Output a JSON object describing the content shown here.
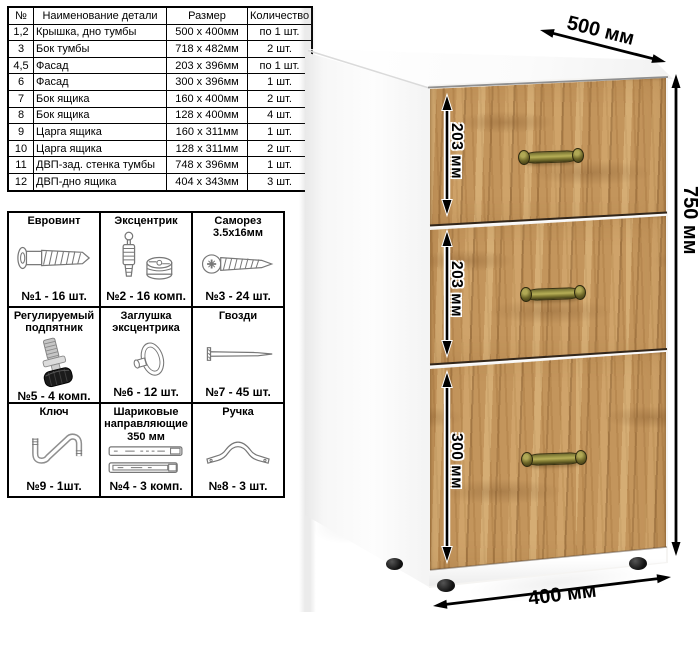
{
  "parts_table": {
    "headers": [
      "№",
      "Наименование детали",
      "Размер",
      "Количество"
    ],
    "rows": [
      [
        "1,2",
        "Крышка, дно тумбы",
        "500 x 400мм",
        "по 1 шт."
      ],
      [
        "3",
        "Бок тумбы",
        "718 x 482мм",
        "2 шт."
      ],
      [
        "4,5",
        "Фасад",
        "203 x 396мм",
        "по 1 шт."
      ],
      [
        "6",
        "Фасад",
        "300 x 396мм",
        "1 шт."
      ],
      [
        "7",
        "Бок ящика",
        "160 x 400мм",
        "2 шт."
      ],
      [
        "8",
        "Бок ящика",
        "128 x 400мм",
        "4 шт."
      ],
      [
        "9",
        "Царга ящика",
        "160 x 311мм",
        "1 шт."
      ],
      [
        "10",
        "Царга ящика",
        "128 x 311мм",
        "2 шт."
      ],
      [
        "11",
        "ДВП-зад. стенка тумбы",
        "748 x 396мм",
        "1 шт."
      ],
      [
        "12",
        "ДВП-дно ящика",
        "404 x 343мм",
        "3 шт."
      ]
    ]
  },
  "hardware": [
    {
      "title": "Евровинт",
      "icon": "euro-screw-icon",
      "count": "№1 - 16 шт."
    },
    {
      "title": "Эксцентрик",
      "icon": "cam-lock-icon",
      "count": "№2 - 16 комп."
    },
    {
      "title": "Саморез 3.5х16мм",
      "icon": "self-tapping-screw-icon",
      "count": "№3 - 24 шт."
    },
    {
      "title": "Регулируемый подпятник",
      "icon": "adjustable-foot-icon",
      "count": "№5 - 4 комп."
    },
    {
      "title": "Заглушка эксцентрика",
      "icon": "cam-cap-icon",
      "count": "№6 - 12 шт."
    },
    {
      "title": "Гвозди",
      "icon": "nail-icon",
      "count": "№7 - 45 шт."
    },
    {
      "title": "Ключ",
      "icon": "hex-key-icon",
      "count": "№9 - 1шт."
    },
    {
      "title": "Шариковые направляющие 350 мм",
      "icon": "ball-slides-icon",
      "count": "№4 - 3 комп."
    },
    {
      "title": "Ручка",
      "icon": "handle-icon",
      "count": "№8 - 3 шт."
    }
  ],
  "dimensions": {
    "width_top": "500 мм",
    "height_right": "750 мм",
    "depth_bottom": "400 мм",
    "drawers": [
      "203 мм",
      "203 мм",
      "300 мм"
    ]
  },
  "colors": {
    "wood": "#c3955c",
    "handle_brass": "#9d9747",
    "line": "#000000",
    "carcass": "#ffffff"
  }
}
